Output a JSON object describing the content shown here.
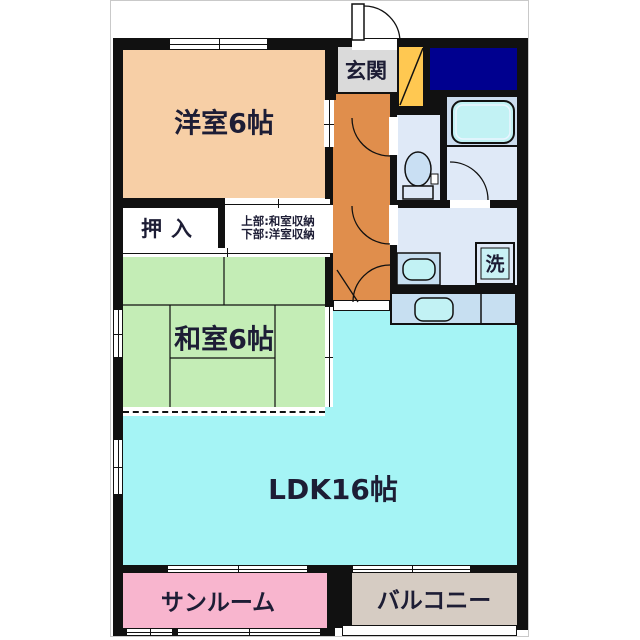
{
  "plan": {
    "type": "japanese-apartment-floorplan",
    "rooms": {
      "western": {
        "label": "洋室6帖",
        "color": "#F7CFA6"
      },
      "japanese": {
        "label": "和室6帖",
        "color": "#C4EDB6"
      },
      "ldk": {
        "label": "LDK16帖",
        "color": "#A5F4F5"
      },
      "entrance": {
        "label": "玄関",
        "color": "#DADADA"
      },
      "hallway": {
        "color": "#E08E4C"
      },
      "oshiire": {
        "label": "押入",
        "color": "#FFFFFF"
      },
      "storage": {
        "line1": "上部:和室収納",
        "line2": "下部:洋室収納",
        "color": "#FFFFFF"
      },
      "laundry": {
        "label": "洗"
      },
      "sunroom": {
        "label": "サンルーム",
        "color": "#F8B5CE"
      },
      "balcony": {
        "label": "バルコニー",
        "color": "#D6CCC3"
      }
    },
    "fixtures": [
      "entrance-door",
      "shoe-cabinet",
      "bathtub",
      "toilet",
      "wash-basin",
      "washing-machine",
      "kitchen-sink"
    ],
    "colors": {
      "wall": "#111111",
      "utility_navy": "#00008F",
      "cabinet_yellow": "#FFC851",
      "fixture_cyan": "#C2F2F4",
      "wet_floor": "#DFE9F7",
      "bath_floor": "#CBDCEE",
      "counter_blue": "#C7DFF1",
      "text": "#1D1D35",
      "frame_gray": "#C9C9C9"
    }
  }
}
